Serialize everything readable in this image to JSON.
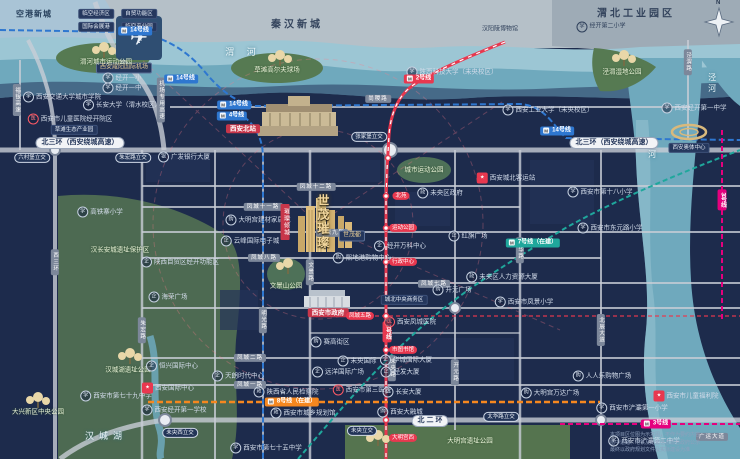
{
  "project": {
    "name": "世茂璀璨",
    "sub_marker": "世茂都",
    "ribbon": "璀璨倾城",
    "accent_gold": "#e9cf96"
  },
  "colors": {
    "map_bg": "#1d2b4c",
    "river": "#6fa9bd",
    "river_light": "#9cc6d4",
    "park": "#55744f",
    "road": "#c8cdd6",
    "metro_line2": "#e8384f",
    "metro_line14": "#2e77d0",
    "metro_line4": "#2e77d0",
    "metro_line7": "#1fa79c",
    "metro_line8": "#f5871f",
    "metro_line3": "#e5007e"
  },
  "compass": "N",
  "disclaimer": {
    "line1": "本项目区位图为示意图，不作为要约内容",
    "line2": "图中道路、地铁及配套信息源自政府公示",
    "line3": "最终以政府规划文件及实际建设为准"
  },
  "labels": [
    {
      "t": "空港新城",
      "k": "region-light",
      "x": 34,
      "y": 14
    },
    {
      "t": "临空经济区",
      "k": "tag",
      "x": 96,
      "y": 14
    },
    {
      "t": "自贸功能区",
      "k": "tag",
      "x": 139,
      "y": 14
    },
    {
      "t": "国际会展港",
      "k": "tag",
      "x": 96,
      "y": 27
    },
    {
      "t": "临空产业园",
      "k": "tag",
      "x": 139,
      "y": 27
    },
    {
      "t": "西安咸阳国际机场",
      "k": "tag-gold",
      "x": 124,
      "y": 68
    },
    {
      "t": "秦汉新城",
      "k": "region",
      "x": 297,
      "y": 25
    },
    {
      "t": "汉阳陵博物馆",
      "k": "poi-dark",
      "x": 500,
      "y": 30
    },
    {
      "t": "渭北工业园区",
      "k": "region",
      "x": 636,
      "y": 14
    },
    {
      "t": "经开第二小学",
      "k": "school-dark",
      "x": 601,
      "y": 27
    },
    {
      "t": "渭 河",
      "k": "river",
      "x": 243,
      "y": 52
    },
    {
      "t": "灞河",
      "k": "river-v",
      "x": 652,
      "y": 150
    },
    {
      "t": "泾河",
      "k": "river-v",
      "x": 712,
      "y": 84
    },
    {
      "t": "汉城湖",
      "k": "river",
      "x": 106,
      "y": 436
    },
    {
      "t": "渭河城市运动公园",
      "k": "park",
      "x": 106,
      "y": 62
    },
    {
      "t": "草滩高尔夫球场",
      "k": "park",
      "x": 277,
      "y": 70
    },
    {
      "t": "泾渭湿地公园",
      "k": "park",
      "x": 622,
      "y": 72
    },
    {
      "t": "城市运动公园",
      "k": "park",
      "x": 424,
      "y": 170
    },
    {
      "t": "文景山公园",
      "k": "park",
      "x": 286,
      "y": 286
    },
    {
      "t": "汉长安城遗址保护区",
      "k": "park",
      "x": 120,
      "y": 250
    },
    {
      "t": "汉城湖遗址公园",
      "k": "park",
      "x": 128,
      "y": 370
    },
    {
      "t": "大兴新区中央公园",
      "k": "park",
      "x": 38,
      "y": 412
    },
    {
      "t": "大明宫遗址公园",
      "k": "park",
      "x": 470,
      "y": 441
    },
    {
      "t": "经开一小",
      "k": "school",
      "x": 122,
      "y": 78
    },
    {
      "t": "经开一中",
      "k": "school",
      "x": 122,
      "y": 88
    },
    {
      "t": "西安交通大学城市学院",
      "k": "school",
      "x": 62,
      "y": 97
    },
    {
      "t": "长安大学（渭水校区）",
      "k": "school",
      "x": 122,
      "y": 105
    },
    {
      "t": "西安市儿童医院经开院区",
      "k": "hospital",
      "x": 70,
      "y": 119
    },
    {
      "t": "草滩生态产业园",
      "k": "tag",
      "x": 74,
      "y": 130
    },
    {
      "t": "陕西科技大学（未央校区）",
      "k": "school",
      "x": 452,
      "y": 72
    },
    {
      "t": "西安工业大学（未央校区）",
      "k": "school",
      "x": 548,
      "y": 110
    },
    {
      "t": "西安经开第一中学",
      "k": "school",
      "x": 694,
      "y": 108
    },
    {
      "t": "高铁寨小学",
      "k": "school",
      "x": 100,
      "y": 212
    },
    {
      "t": "西安市第十八小学",
      "k": "school",
      "x": 600,
      "y": 192
    },
    {
      "t": "西安市东元路小学",
      "k": "school",
      "x": 610,
      "y": 228
    },
    {
      "t": "西安市凤景小学",
      "k": "school",
      "x": 524,
      "y": 302
    },
    {
      "t": "西安经开第一学校",
      "k": "school",
      "x": 174,
      "y": 410
    },
    {
      "t": "西安市第七十五中学",
      "k": "school",
      "x": 266,
      "y": 448
    },
    {
      "t": "西安市第七十九中学",
      "k": "school",
      "x": 116,
      "y": 396
    },
    {
      "t": "西安市浐灞第一小学",
      "k": "school",
      "x": 632,
      "y": 408
    },
    {
      "t": "西安市浐灞第二中学",
      "k": "school",
      "x": 644,
      "y": 441
    },
    {
      "t": "西安北站",
      "k": "red-tag",
      "x": 243,
      "y": 129
    },
    {
      "t": "西安市政府",
      "k": "red-tag",
      "x": 328,
      "y": 313
    },
    {
      "t": "西安城北客运站",
      "k": "red-poi",
      "x": 506,
      "y": 178
    },
    {
      "t": "西安国际中心",
      "k": "red-poi",
      "x": 168,
      "y": 388
    },
    {
      "t": "西安市儿童福利院",
      "k": "red-poi",
      "x": 686,
      "y": 396
    },
    {
      "t": "西安奥体中心",
      "k": "tag",
      "x": 689,
      "y": 148
    },
    {
      "t": "城北中央商务区",
      "k": "tag",
      "x": 404,
      "y": 300
    },
    {
      "t": "北三环（西安绕城高速）",
      "k": "hw",
      "x": 80,
      "y": 143
    },
    {
      "t": "北三环（西安绕城高速）",
      "k": "hw",
      "x": 614,
      "y": 143
    },
    {
      "t": "北 二 环",
      "k": "hw",
      "x": 430,
      "y": 421
    },
    {
      "t": "六村堡立交",
      "k": "ic",
      "x": 32,
      "y": 158
    },
    {
      "t": "朱宏路立交",
      "k": "ic",
      "x": 133,
      "y": 158
    },
    {
      "t": "张家堡立交",
      "k": "ic",
      "x": 369,
      "y": 137
    },
    {
      "t": "未央西立交",
      "k": "ic",
      "x": 180,
      "y": 433
    },
    {
      "t": "未央立交",
      "k": "ic",
      "x": 362,
      "y": 431
    },
    {
      "t": "太华路立交",
      "k": "ic",
      "x": 501,
      "y": 417
    },
    {
      "t": "机场专用高速",
      "k": "road-v",
      "x": 161,
      "y": 100
    },
    {
      "t": "福银高速",
      "k": "road-v",
      "x": 17,
      "y": 100
    },
    {
      "t": "西三环",
      "k": "road-v",
      "x": 55,
      "y": 262
    },
    {
      "t": "泾渭路",
      "k": "road-v",
      "x": 688,
      "y": 62
    },
    {
      "t": "尚稷路",
      "k": "road",
      "x": 378,
      "y": 99
    },
    {
      "t": "凤城十二路",
      "k": "road",
      "x": 316,
      "y": 187
    },
    {
      "t": "凤城十一路",
      "k": "road",
      "x": 263,
      "y": 207
    },
    {
      "t": "凤城九路",
      "k": "road",
      "x": 332,
      "y": 233
    },
    {
      "t": "凤城八路",
      "k": "road",
      "x": 264,
      "y": 258
    },
    {
      "t": "凤城七路",
      "k": "road",
      "x": 434,
      "y": 284
    },
    {
      "t": "凤城二路",
      "k": "road",
      "x": 250,
      "y": 358
    },
    {
      "t": "凤城一路",
      "k": "road",
      "x": 250,
      "y": 385
    },
    {
      "t": "文景路",
      "k": "road-v",
      "x": 310,
      "y": 272
    },
    {
      "t": "明光路",
      "k": "road-v",
      "x": 263,
      "y": 320
    },
    {
      "t": "朱宏路",
      "k": "road-v",
      "x": 142,
      "y": 330
    },
    {
      "t": "未央路",
      "k": "road-v",
      "x": 392,
      "y": 368
    },
    {
      "t": "开元路",
      "k": "road-v",
      "x": 455,
      "y": 372
    },
    {
      "t": "太华路",
      "k": "road-v",
      "x": 520,
      "y": 250
    },
    {
      "t": "北辰大道",
      "k": "road-v",
      "x": 601,
      "y": 330
    },
    {
      "t": "广运大道",
      "k": "road",
      "x": 712,
      "y": 437
    },
    {
      "t": "凤城五路",
      "k": "station",
      "x": 360,
      "y": 316
    },
    {
      "t": "北苑",
      "k": "station",
      "x": 401,
      "y": 196
    },
    {
      "t": "运动公园",
      "k": "station",
      "x": 403,
      "y": 228
    },
    {
      "t": "行政中心",
      "k": "station",
      "x": 403,
      "y": 262
    },
    {
      "t": "市图书馆",
      "k": "station",
      "x": 403,
      "y": 350
    },
    {
      "t": "大明宫西",
      "k": "station",
      "x": 403,
      "y": 438
    },
    {
      "t": "14号线",
      "k": "m-blue",
      "x": 135,
      "y": 31
    },
    {
      "t": "14号线",
      "k": "m-blue",
      "x": 181,
      "y": 79
    },
    {
      "t": "14号线",
      "k": "m-blue",
      "x": 234,
      "y": 105
    },
    {
      "t": "4号线",
      "k": "m-blue",
      "x": 232,
      "y": 116
    },
    {
      "t": "14号线",
      "k": "m-blue",
      "x": 557,
      "y": 131
    },
    {
      "t": "2号线",
      "k": "m-red",
      "x": 419,
      "y": 79
    },
    {
      "t": "2号线",
      "k": "m-red-v",
      "x": 387,
      "y": 332
    },
    {
      "t": "7号线（在建）",
      "k": "m-teal",
      "x": 533,
      "y": 243
    },
    {
      "t": "8号线（在建）",
      "k": "m-orange",
      "x": 292,
      "y": 402
    },
    {
      "t": "3号线",
      "k": "m-mag-v",
      "x": 722,
      "y": 200
    },
    {
      "t": "3号线",
      "k": "m-mag",
      "x": 656,
      "y": 424
    },
    {
      "t": "广发银行大厦",
      "k": "bank",
      "x": 184,
      "y": 157
    },
    {
      "t": "未央区政府",
      "k": "gov",
      "x": 440,
      "y": 193
    },
    {
      "t": "大明宫建材家居城",
      "k": "shop",
      "x": 258,
      "y": 220
    },
    {
      "t": "云峰国际电子城",
      "k": "poi",
      "x": 250,
      "y": 241
    },
    {
      "t": "陕西自贸区经开功能区",
      "k": "poi",
      "x": 180,
      "y": 262
    },
    {
      "t": "海荣广场",
      "k": "poi",
      "x": 168,
      "y": 297
    },
    {
      "t": "熙地港购物中心",
      "k": "shop",
      "x": 362,
      "y": 258
    },
    {
      "t": "经开万科中心",
      "k": "poi",
      "x": 400,
      "y": 246
    },
    {
      "t": "红旗广场",
      "k": "poi",
      "x": 468,
      "y": 236
    },
    {
      "t": "开元广场",
      "k": "shop",
      "x": 452,
      "y": 290
    },
    {
      "t": "未央区人力资源大厦",
      "k": "gov",
      "x": 502,
      "y": 277
    },
    {
      "t": "西安凤城医院",
      "k": "hospital",
      "x": 410,
      "y": 322
    },
    {
      "t": "赛高街区",
      "k": "shop",
      "x": 330,
      "y": 342
    },
    {
      "t": "未央国际",
      "k": "poi",
      "x": 357,
      "y": 361
    },
    {
      "t": "远洋国际广场",
      "k": "poi",
      "x": 338,
      "y": 372
    },
    {
      "t": "华城国际大厦",
      "k": "poi",
      "x": 406,
      "y": 360
    },
    {
      "t": "经发大厦",
      "k": "poi",
      "x": 400,
      "y": 372
    },
    {
      "t": "长安大厦",
      "k": "poi",
      "x": 402,
      "y": 392
    },
    {
      "t": "西安市第三医院",
      "k": "hospital",
      "x": 362,
      "y": 390
    },
    {
      "t": "西安大融城",
      "k": "shop",
      "x": 400,
      "y": 412
    },
    {
      "t": "人人乐购物广场",
      "k": "shop",
      "x": 602,
      "y": 376
    },
    {
      "t": "大明宫万达广场",
      "k": "shop",
      "x": 550,
      "y": 393
    },
    {
      "t": "恒兴国际中心",
      "k": "poi",
      "x": 172,
      "y": 366
    },
    {
      "t": "天朗时代中心",
      "k": "poi",
      "x": 238,
      "y": 376
    },
    {
      "t": "陕西省人民检察院",
      "k": "gov",
      "x": 286,
      "y": 392
    },
    {
      "t": "西安市城乡规划馆",
      "k": "gov",
      "x": 303,
      "y": 413
    }
  ]
}
